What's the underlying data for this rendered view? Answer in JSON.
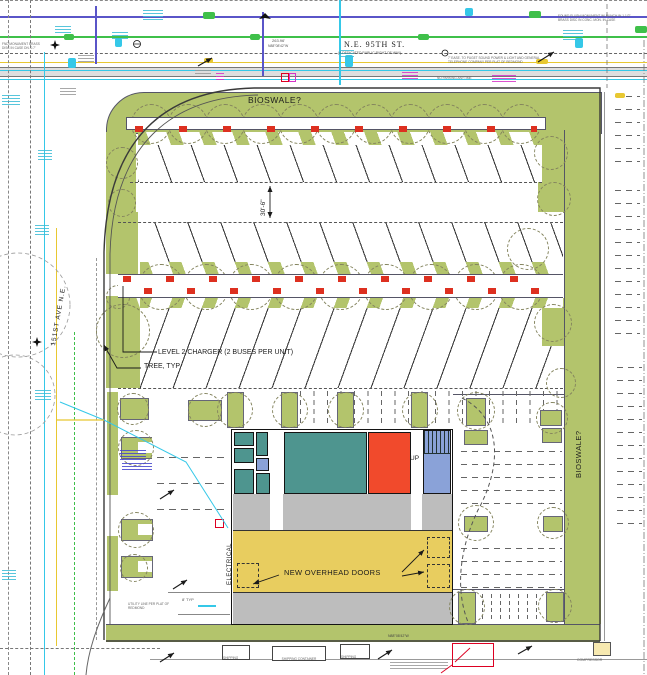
{
  "streets": {
    "north": {
      "name": "N.E. 95TH ST.",
      "subtitle": "(A DEDICATED PUBLIC RIGHT OF WAY)",
      "distance": "263.96'",
      "bearing": "N88°08'42\"W"
    },
    "west": {
      "name": "151ST AVE N.E."
    },
    "south_bearing": "N88°08'42\"W"
  },
  "site": {
    "bioswale_top": "BIOSWALE?",
    "bioswale_right": "BIOSWALE?",
    "charger_callout": "LEVEL 2 CHARGER (2 BUSES PER UNIT)",
    "tree_callout": "TREE, TYP",
    "aisle_width": "30'-6\"",
    "stall_width": "8' TYP"
  },
  "building": {
    "overhead_doors_callout": "NEW OVERHEAD DOORS",
    "electrical_room": "ELECTRICAL",
    "stairs": "UP"
  },
  "annotations": {
    "no_parking": "NO PARKING ANYTIME",
    "easement": "7' EASE. TO PUGET SOUND POWER & LIGHT AND GENERAL TELEPHONE COMPANY PER PLAT OF REDMOND",
    "monument_nw": "FND MONUMENT BRASS DISC IN CASE DN. 0.7'",
    "monument_ne": "FOUND FLUSH MONUMENT W/ PUNCH IN 1-1/2\" BRASS DISC IN CONC. MON. IN CASE",
    "utility_note": "UTILITY LINE PER PLAT OF REDMOND",
    "shipping_container": "SHIPPING CONTAINER",
    "compressor": "COMPRESSOR"
  },
  "colors": {
    "landscape": "#b3c46c",
    "room_teal": "#4e958f",
    "room_red": "#f14a2c",
    "room_blue": "#8aa2d8",
    "bay_yellow": "#e8cd5f",
    "bay_gray": "#bdbdbd",
    "charger_red": "#dd3020",
    "util_cyan": "#35c8e8",
    "util_green": "#3fc04a",
    "util_yellow": "#e8c832",
    "util_blue": "#5a55c8",
    "util_magenta": "#d633c8"
  }
}
